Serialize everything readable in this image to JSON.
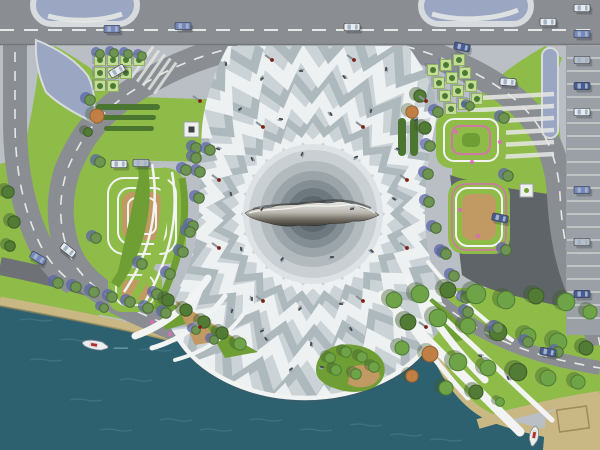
{
  "scene_title": "waterfront-plaza-master-plan-aerial-rendering",
  "palette": {
    "sidewalk": "#b9bfc4",
    "roadGray": "#8a8e92",
    "roadDark": "#6e7276",
    "asphaltDark": "#5f6468",
    "laneWhite": "#e6e8e5",
    "plazaBase": "#ccd3d7",
    "rippleLight": "#eef1f2",
    "rippleGray": "#aeb9be",
    "innerDisc": "#dde2e5",
    "water": "#2d6170",
    "waterLight": "#4a8191",
    "sand": "#c9b883",
    "sandEdge": "#9d8c5c",
    "lawn": "#8fbc49",
    "lawnDark": "#6f9e35",
    "hedge": "#4a7630",
    "grassStrip": "#b9cc4e",
    "islandBlue": "#9aa6c2",
    "islandRim": "#d8dbde",
    "white": "#f2f4f3",
    "pink": "#d66fb4",
    "tanBed": "#c09a62",
    "poleRed": "#7c2214",
    "poleShadow": "#8b949a",
    "person": "#444a52",
    "personShadow": "#9aa3ab",
    "carBlue": "#7787bd",
    "carNavy": "#4a5a94",
    "carWhite": "#e8eaec",
    "carSilver": "#b9bec6",
    "carOutline": "#3e4650",
    "treeG": "#6fa348",
    "treeGd": "#4e7d33",
    "treeD": "#527b35",
    "treeDd": "#3c5c26",
    "treeO": "#c08045",
    "treeOd": "#96602f",
    "treeB": "#6d9450",
    "treeBd": "#4b6e38",
    "treeShadow": "#5e66a8",
    "parkShadow": "#3f5a2e",
    "squareTree": "#c3dc96",
    "squareTreeEdge": "#93b05e",
    "squareTreeCore": "#4b7a34",
    "sculptLight": "#e8e8e4",
    "sculptMid": "#b9b7b0",
    "sculptDark": "#6b665e",
    "sculptDeep": "#3f3c38"
  },
  "plaza": {
    "center": {
      "x": 313,
      "y": 214
    },
    "inner_disc_r": 70,
    "core_circles": [
      [
        64,
        "#c9cfd2"
      ],
      [
        53,
        "#b2babe"
      ],
      [
        43,
        "#9aa4a9"
      ],
      [
        34,
        "#838e94"
      ],
      [
        26,
        "#6e797f"
      ],
      [
        18,
        "#5d686e"
      ]
    ],
    "ripple_rings": [
      [
        74,
        6,
        22,
        9,
        "L",
        0
      ],
      [
        90,
        8,
        22,
        7,
        "G",
        0.14
      ],
      [
        108,
        10,
        24,
        11,
        "L",
        0.06
      ],
      [
        128,
        12,
        24,
        8,
        "G",
        0.12
      ],
      [
        150,
        14,
        26,
        12,
        "L",
        0.04
      ],
      [
        174,
        16,
        26,
        9,
        "G",
        0.1
      ],
      [
        200,
        18,
        28,
        13,
        "L",
        0.05
      ],
      [
        228,
        20,
        28,
        10,
        "G",
        0.11
      ]
    ]
  },
  "trees": {
    "round": [
      [
        58,
        283,
        6,
        "b"
      ],
      [
        76,
        287,
        6,
        "b"
      ],
      [
        94,
        292,
        6,
        "b"
      ],
      [
        112,
        297,
        6,
        "b"
      ],
      [
        130,
        302,
        6,
        "b"
      ],
      [
        148,
        308,
        6,
        "b"
      ],
      [
        166,
        313,
        6,
        "b"
      ],
      [
        196,
        148,
        6,
        "b"
      ],
      [
        200,
        172,
        6,
        "b"
      ],
      [
        199,
        198,
        6,
        "b"
      ],
      [
        193,
        226,
        6,
        "b"
      ],
      [
        183,
        252,
        6,
        "b"
      ],
      [
        170,
        274,
        6,
        "b"
      ],
      [
        157,
        294,
        6,
        "b"
      ],
      [
        100,
        162,
        6,
        "b"
      ],
      [
        186,
        170,
        6,
        "b"
      ],
      [
        190,
        232,
        6,
        "b"
      ],
      [
        96,
        238,
        6,
        "b"
      ],
      [
        142,
        264,
        6,
        "b"
      ],
      [
        104,
        308,
        5,
        "b"
      ],
      [
        90,
        100,
        6,
        "b"
      ],
      [
        97,
        116,
        8,
        "o"
      ],
      [
        210,
        150,
        6,
        "b"
      ],
      [
        196,
        158,
        6,
        "b"
      ],
      [
        88,
        132,
        5,
        "d"
      ],
      [
        100,
        54,
        5,
        "b"
      ],
      [
        114,
        53,
        5,
        "b"
      ],
      [
        128,
        54,
        5,
        "b"
      ],
      [
        142,
        56,
        5,
        "b"
      ],
      [
        430,
        146,
        6,
        "b"
      ],
      [
        428,
        174,
        6,
        "b"
      ],
      [
        429,
        202,
        6,
        "b"
      ],
      [
        436,
        228,
        6,
        "b"
      ],
      [
        444,
        252,
        6,
        "b"
      ],
      [
        454,
        276,
        6,
        "b"
      ],
      [
        466,
        298,
        6,
        "b"
      ],
      [
        438,
        112,
        6,
        "b"
      ],
      [
        504,
        118,
        6,
        "b"
      ],
      [
        508,
        176,
        6,
        "b"
      ],
      [
        446,
        254,
        6,
        "b"
      ],
      [
        506,
        250,
        6,
        "b"
      ],
      [
        470,
        106,
        5,
        "b"
      ],
      [
        420,
        96,
        7,
        "d"
      ],
      [
        412,
        112,
        7,
        "o"
      ],
      [
        425,
        128,
        7,
        "d"
      ],
      [
        394,
        300,
        9,
        "g"
      ],
      [
        420,
        294,
        10,
        "g"
      ],
      [
        448,
        290,
        9,
        "d"
      ],
      [
        476,
        294,
        11,
        "g"
      ],
      [
        506,
        300,
        10,
        "g"
      ],
      [
        536,
        296,
        9,
        "d"
      ],
      [
        566,
        302,
        10,
        "g"
      ],
      [
        590,
        312,
        8,
        "g"
      ],
      [
        408,
        322,
        9,
        "d"
      ],
      [
        438,
        318,
        10,
        "g"
      ],
      [
        468,
        326,
        9,
        "g"
      ],
      [
        498,
        332,
        10,
        "d"
      ],
      [
        528,
        336,
        9,
        "g"
      ],
      [
        558,
        342,
        10,
        "g"
      ],
      [
        586,
        348,
        8,
        "d"
      ],
      [
        402,
        348,
        8,
        "g"
      ],
      [
        430,
        354,
        9,
        "o"
      ],
      [
        458,
        362,
        10,
        "g"
      ],
      [
        488,
        368,
        9,
        "g"
      ],
      [
        518,
        372,
        10,
        "d"
      ],
      [
        548,
        378,
        9,
        "g"
      ],
      [
        578,
        382,
        8,
        "g"
      ],
      [
        446,
        388,
        8,
        "g"
      ],
      [
        476,
        392,
        8,
        "d"
      ],
      [
        412,
        376,
        7,
        "o"
      ],
      [
        500,
        402,
        5,
        "g"
      ],
      [
        168,
        300,
        7,
        "d"
      ],
      [
        186,
        310,
        7,
        "d"
      ],
      [
        204,
        322,
        7,
        "d"
      ],
      [
        222,
        333,
        7,
        "d"
      ],
      [
        240,
        344,
        7,
        "g"
      ],
      [
        330,
        358,
        6,
        "g"
      ],
      [
        346,
        352,
        6,
        "g"
      ],
      [
        362,
        357,
        6,
        "g"
      ],
      [
        374,
        367,
        6,
        "g"
      ],
      [
        356,
        374,
        6,
        "g"
      ],
      [
        336,
        370,
        6,
        "g"
      ],
      [
        8,
        192,
        7,
        "d"
      ],
      [
        14,
        222,
        7,
        "d"
      ],
      [
        10,
        246,
        6,
        "d"
      ],
      [
        196,
        330,
        5,
        "b"
      ],
      [
        214,
        340,
        5,
        "b"
      ],
      [
        468,
        312,
        6,
        "b"
      ],
      [
        498,
        328,
        6,
        "b"
      ],
      [
        528,
        342,
        6,
        "b"
      ],
      [
        558,
        352,
        6,
        "b"
      ]
    ],
    "squares_left": [
      [
        100,
        60
      ],
      [
        113,
        60
      ],
      [
        126,
        60
      ],
      [
        139,
        60
      ],
      [
        100,
        73
      ],
      [
        113,
        73
      ],
      [
        126,
        73
      ],
      [
        100,
        86
      ],
      [
        113,
        86
      ]
    ],
    "squares_right": [
      [
        433,
        70
      ],
      [
        446,
        65
      ],
      [
        459,
        60
      ],
      [
        439,
        83
      ],
      [
        452,
        78
      ],
      [
        465,
        73
      ],
      [
        445,
        96
      ],
      [
        458,
        91
      ],
      [
        471,
        86
      ],
      [
        451,
        109
      ],
      [
        464,
        104
      ],
      [
        477,
        99
      ]
    ]
  },
  "cars": [
    [
      112,
      29,
      0,
      "carBlue"
    ],
    [
      183,
      26,
      0,
      "carBlue"
    ],
    [
      352,
      27,
      0,
      "carWhite"
    ],
    [
      462,
      47,
      12,
      "carNavy"
    ],
    [
      548,
      22,
      0,
      "carWhite"
    ],
    [
      117,
      71,
      -30,
      "carWhite"
    ],
    [
      68,
      250,
      38,
      "carWhite"
    ],
    [
      38,
      258,
      30,
      "carBlue"
    ],
    [
      119,
      164,
      0,
      "carWhite"
    ],
    [
      141,
      163,
      0,
      "carSilver"
    ],
    [
      500,
      218,
      12,
      "carNavy"
    ],
    [
      508,
      82,
      4,
      "carWhite"
    ],
    [
      548,
      352,
      10,
      "carNavy"
    ]
  ],
  "parking": {
    "stall_count": 25,
    "cars": [
      [
        582,
        8
      ],
      [
        582,
        34
      ],
      [
        582,
        60
      ],
      [
        582,
        86
      ],
      [
        582,
        112
      ],
      [
        582,
        190
      ],
      [
        582,
        242
      ],
      [
        582,
        294
      ]
    ]
  },
  "boats": [
    {
      "x": 95,
      "y": 345,
      "rot": 10,
      "len": 26
    },
    {
      "x": 534,
      "y": 436,
      "rot": 100,
      "len": 20
    }
  ],
  "light_poles": [
    [
      363,
      127
    ],
    [
      407,
      180
    ],
    [
      407,
      248
    ],
    [
      363,
      301
    ],
    [
      263,
      301
    ],
    [
      219,
      248
    ],
    [
      219,
      180
    ],
    [
      263,
      127
    ],
    [
      354,
      60
    ],
    [
      272,
      60
    ],
    [
      426,
      101
    ],
    [
      200,
      101
    ],
    [
      426,
      327
    ],
    [
      200,
      327
    ]
  ],
  "people": [
    [
      226,
      64
    ],
    [
      262,
      79
    ],
    [
      301,
      71
    ],
    [
      344,
      77
    ],
    [
      386,
      69
    ],
    [
      240,
      109
    ],
    [
      281,
      119
    ],
    [
      331,
      114
    ],
    [
      371,
      111
    ],
    [
      416,
      120
    ],
    [
      218,
      149
    ],
    [
      252,
      159
    ],
    [
      302,
      154
    ],
    [
      356,
      157
    ],
    [
      398,
      149
    ],
    [
      231,
      194
    ],
    [
      262,
      209
    ],
    [
      352,
      209
    ],
    [
      394,
      199
    ],
    [
      241,
      249
    ],
    [
      282,
      259
    ],
    [
      332,
      257
    ],
    [
      372,
      251
    ],
    [
      252,
      299
    ],
    [
      300,
      309
    ],
    [
      341,
      304
    ],
    [
      266,
      339
    ],
    [
      311,
      344
    ],
    [
      291,
      369
    ],
    [
      322,
      367
    ],
    [
      351,
      329
    ],
    [
      232,
      311
    ],
    [
      262,
      331
    ],
    [
      480,
      356
    ],
    [
      508,
      378
    ]
  ],
  "flowers": [
    [
      8,
      196
    ],
    [
      16,
      226
    ],
    [
      11,
      248
    ],
    [
      150,
      292
    ],
    [
      134,
      302
    ],
    [
      456,
      132
    ],
    [
      472,
      162
    ],
    [
      500,
      142
    ],
    [
      152,
      322
    ],
    [
      170,
      334
    ],
    [
      460,
      210
    ],
    [
      478,
      236
    ]
  ],
  "water_streaks": [
    [
      30,
      360
    ],
    [
      70,
      400
    ],
    [
      120,
      380
    ],
    [
      160,
      420
    ],
    [
      200,
      430
    ],
    [
      250,
      420
    ],
    [
      60,
      340
    ],
    [
      100,
      430
    ],
    [
      300,
      430
    ],
    [
      350,
      425
    ],
    [
      390,
      435
    ],
    [
      430,
      440
    ],
    [
      20,
      320
    ],
    [
      140,
      350
    ]
  ],
  "crosswalk_right": {
    "bars": 6,
    "x": 470,
    "y0": 94,
    "step": 12,
    "w": 84,
    "h": 4.5
  },
  "hatch_left": {
    "bars": 5,
    "x": 134,
    "y0": 56,
    "step": 7,
    "w": 38,
    "h": 3
  }
}
